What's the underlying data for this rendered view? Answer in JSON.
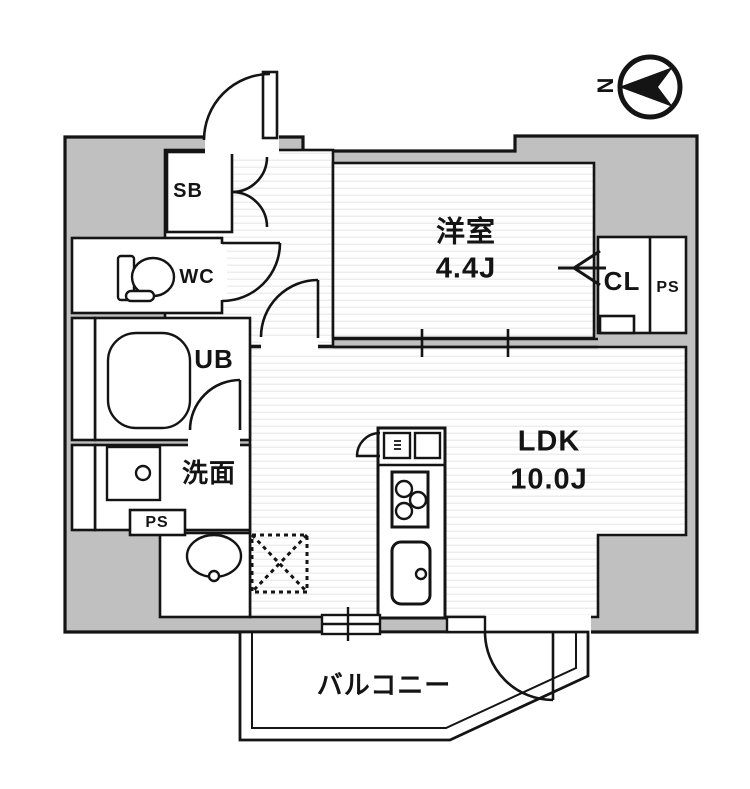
{
  "compass": {
    "north_label": "N"
  },
  "rooms": {
    "western": {
      "name": "洋室",
      "area": "4.4J"
    },
    "ldk": {
      "name": "LDK",
      "area": "10.0J"
    },
    "balcony": {
      "name": "バルコニー"
    },
    "shoe_box": {
      "abbr": "SB"
    },
    "toilet": {
      "abbr": "WC"
    },
    "unit_bath": {
      "abbr": "UB"
    },
    "washroom": {
      "name": "洗面"
    },
    "closet": {
      "abbr": "CL"
    },
    "pipe_space_left": {
      "abbr": "PS"
    },
    "pipe_space_right": {
      "abbr": "PS"
    }
  },
  "colors": {
    "wall": "#141414",
    "building_fill": "#c0c0c0",
    "floor_stripe": "#e9e9e9"
  }
}
